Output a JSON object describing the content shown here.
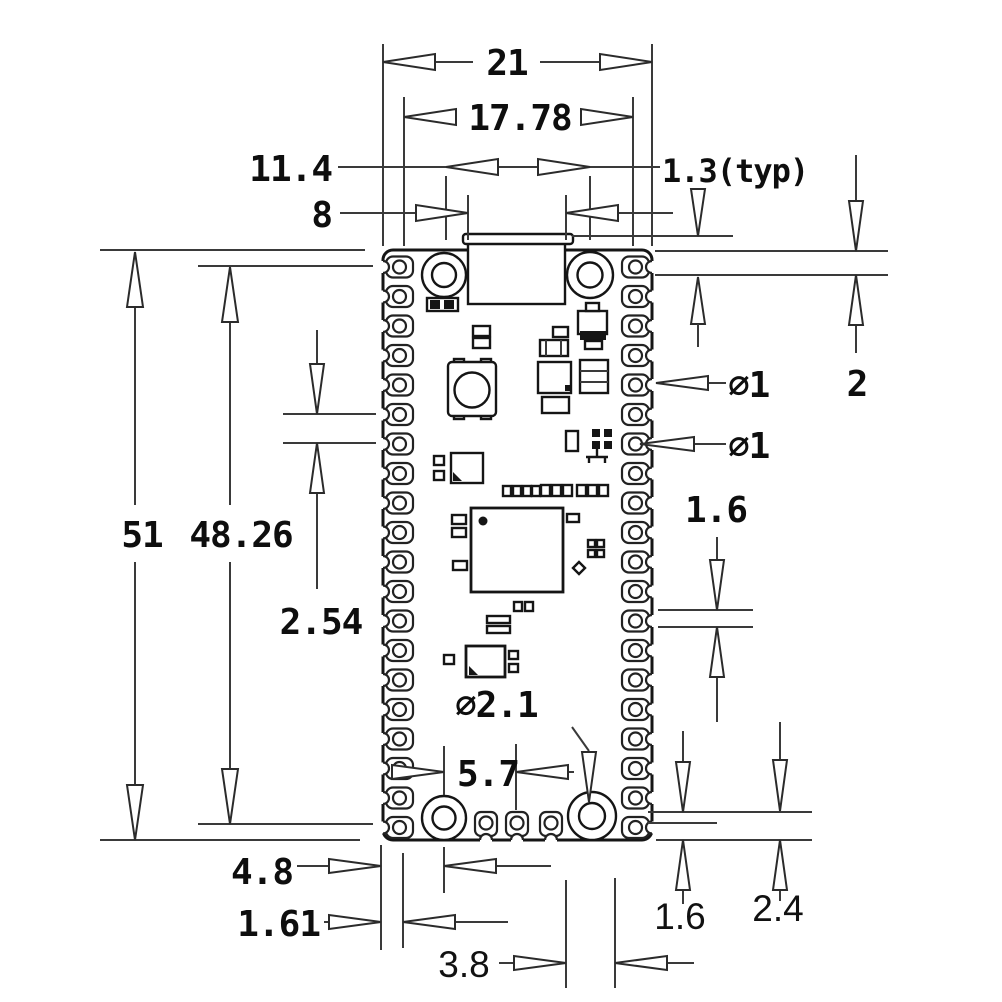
{
  "drawing": {
    "description": "Mechanical dimension drawing of a castellated microcontroller board (top view)",
    "units": "mm",
    "dimensions": {
      "board_width": "21",
      "pin_row_span": "17.78",
      "mount_hole_span": "11.4",
      "usb_width": "8",
      "pad_length_typ": "1.3(typ)",
      "top_edge_to_pin": "2",
      "pin_hole_dia_a": "∅1",
      "pin_hole_dia_b": "∅1",
      "board_length": "51",
      "pin_column_span": "48.26",
      "pin_pitch": "2.54",
      "pad_height_right": "1.6",
      "mount_hole_dia": "∅2.1",
      "hole_to_debug_pad": "5.7",
      "edge_to_hole": "4.8",
      "pad_width": "1.61",
      "debug_pad_span": "3.8",
      "bottom_pad_length": "1.6",
      "bottom_edge_offset": "2.4"
    }
  }
}
